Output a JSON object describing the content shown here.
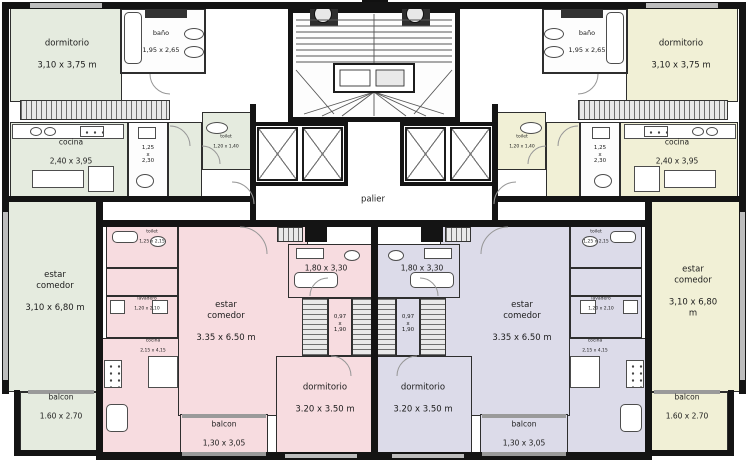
{
  "plan": {
    "palier_label": "palier",
    "colors": {
      "green": "#e5ebdf",
      "cream": "#f1f0d6",
      "pink": "#f7dce0",
      "lav": "#dcdbe9"
    },
    "apt_top_left": {
      "dormitorio_name": "dormitorio",
      "dormitorio_dims": "3,10 x 3,75 m",
      "bano_name": "baño",
      "bano_dims": "1,95 x 2,65",
      "cocina_name": "cocina",
      "cocina_dims": "2,40 x 3,95",
      "toilette_dims": "1,25\nx\n2,30",
      "toilet_name": "toilet",
      "toilet_dims": "1,20 x 1,40",
      "estar_name": "estar\ncomedor",
      "estar_dims": "3,10 x 6,80 m",
      "balcon_name": "balcon",
      "balcon_dims": "1.60 x 2.70"
    },
    "apt_top_right": {
      "dormitorio_name": "dormitorio",
      "dormitorio_dims": "3,10 x 3,75 m",
      "bano_name": "baño",
      "bano_dims": "1,95 x 2,65",
      "cocina_name": "cocina",
      "cocina_dims": "2,40 x 3,95",
      "toilette_dims": "1,25\nx\n2,30",
      "toilet_name": "toilet",
      "toilet_dims": "1,20 x 1,40",
      "estar_name": "estar\ncomedor",
      "estar_dims": "3,10 x 6,80 m",
      "balcon_name": "balcon",
      "balcon_dims": "1.60 x 2.70"
    },
    "apt_bottom_left": {
      "estar_name": "estar\ncomedor",
      "estar_dims": "3.35 x 6.50 m",
      "bano_dims": "1,80 x 3,30",
      "pasillo_dims": "0,97\nx\n1,90",
      "dormitorio_name": "dormitorio",
      "dormitorio_dims": "3.20 x 3.50 m",
      "balcon_name": "balcon",
      "balcon_dims": "1,30 x 3,05",
      "toilet_name": "toilet",
      "toilet_dims": "1,25 x 2,15",
      "lavadero_name": "lavadero",
      "lavadero_dims": "1,20 x 2,10",
      "cocina_name": "cocina",
      "cocina_dims": "2,15 x 4,15"
    },
    "apt_bottom_right": {
      "estar_name": "estar\ncomedor",
      "estar_dims": "3.35 x 6.50 m",
      "bano_dims": "1,80 x 3,30",
      "pasillo_dims": "0,97\nx\n1,90",
      "dormitorio_name": "dormitorio",
      "dormitorio_dims": "3.20 x 3.50 m",
      "balcon_name": "balcon",
      "balcon_dims": "1,30 x 3,05",
      "toilet_name": "toilet",
      "toilet_dims": "1,25 x 2,15",
      "lavadero_name": "lavadero",
      "lavadero_dims": "1,20 x 2,10",
      "cocina_name": "cocina",
      "cocina_dims": "2,15 x 4,15"
    }
  }
}
